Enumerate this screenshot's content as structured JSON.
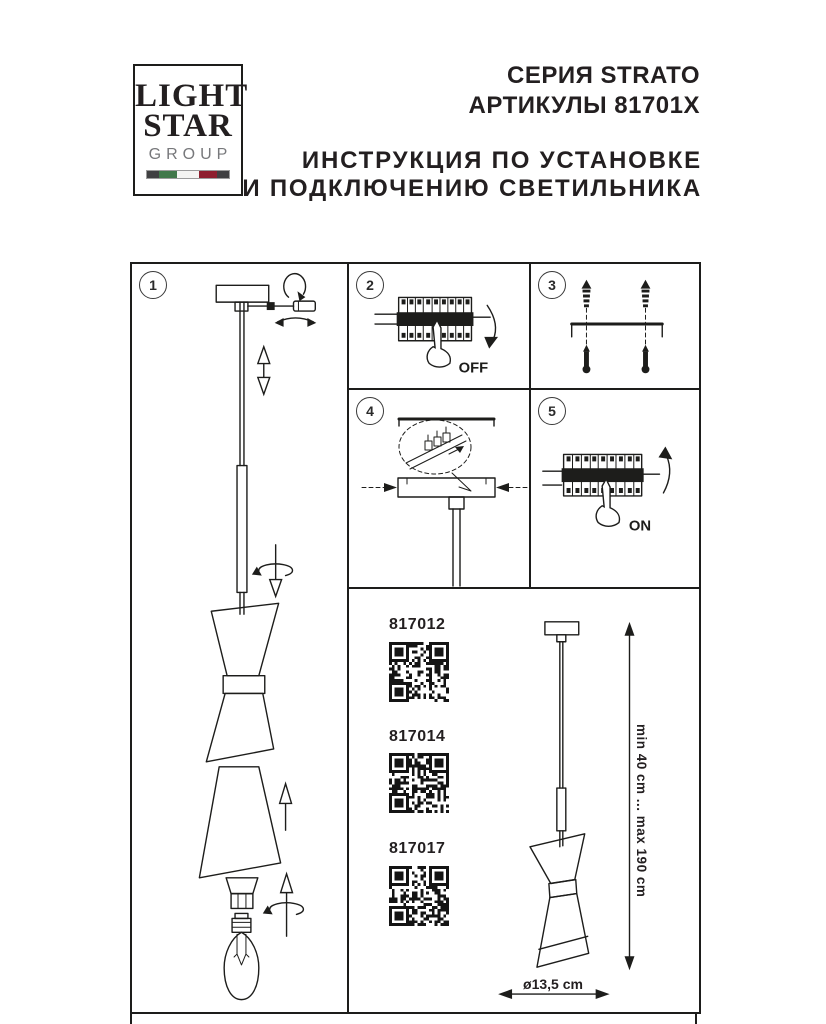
{
  "header": {
    "logo": {
      "line1": "LIGHT",
      "line2": "STAR",
      "line3": "GROUP"
    },
    "series": "СЕРИЯ STRATO",
    "articles": "АРТИКУЛЫ 81701X",
    "title_line1": "ИНСТРУКЦИЯ ПО УСТАНОВКЕ",
    "title_line2": "И ПОДКЛЮЧЕНИЮ СВЕТИЛЬНИКА"
  },
  "steps": {
    "s1": {
      "number": "1"
    },
    "s2": {
      "number": "2",
      "switch_label": "OFF"
    },
    "s3": {
      "number": "3"
    },
    "s4": {
      "number": "4"
    },
    "s5": {
      "number": "5",
      "switch_label": "ON"
    }
  },
  "products": {
    "items": [
      {
        "article": "817012"
      },
      {
        "article": "817014"
      },
      {
        "article": "817017"
      }
    ],
    "height_range": "min 40 cm ... max 190 cm",
    "diameter": "ø13,5 cm"
  },
  "colors": {
    "ink": "#1d1d1b",
    "flag_green": "#41784a",
    "flag_white": "#f4f4f2",
    "flag_red": "#8e1f2f",
    "flag_dark": "#404042",
    "logo_gray": "#77787b"
  }
}
